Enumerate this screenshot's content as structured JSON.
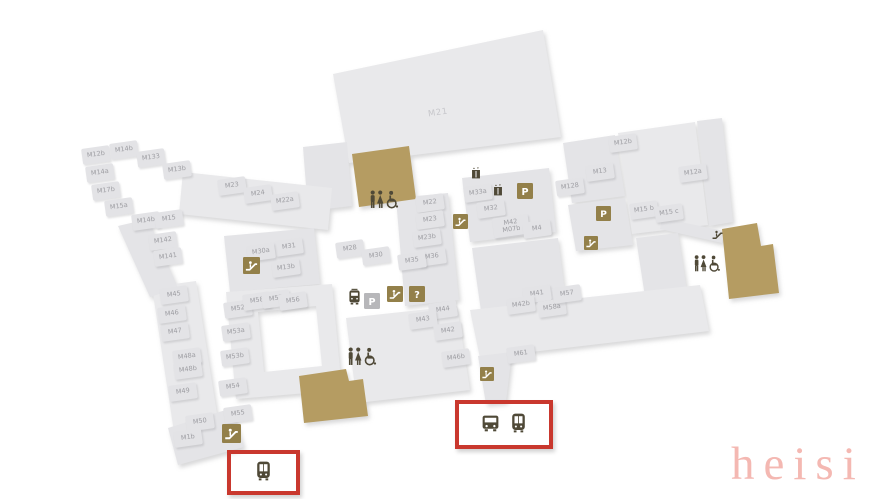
{
  "watermark": {
    "text": "heisi",
    "color": "#f4b8b2"
  },
  "map": {
    "colors": {
      "shape": "#e9e9eb",
      "unit_cell": "#e3e3e6",
      "unit_text": "#9c9ca1",
      "accent_building": "#b59c62",
      "icon_box": "#93804a",
      "glyph_dark": "#4f4937",
      "parking_gray_box": "#b7b7ba",
      "highlight_red": "#c9382e",
      "faint_label": "#c7c7cb"
    },
    "big_labels": [
      {
        "label": "M21",
        "x": 438,
        "y": 113
      }
    ],
    "units": [
      {
        "label": "M12b",
        "x": 96,
        "y": 155
      },
      {
        "label": "M14b",
        "x": 124,
        "y": 150
      },
      {
        "label": "M133",
        "x": 151,
        "y": 158
      },
      {
        "label": "M13b",
        "x": 177,
        "y": 170
      },
      {
        "label": "M14a",
        "x": 100,
        "y": 173
      },
      {
        "label": "M17b",
        "x": 106,
        "y": 191
      },
      {
        "label": "M15a",
        "x": 119,
        "y": 207
      },
      {
        "label": "M14b",
        "x": 146,
        "y": 221
      },
      {
        "label": "M15",
        "x": 169,
        "y": 219
      },
      {
        "label": "M142",
        "x": 163,
        "y": 241
      },
      {
        "label": "M141",
        "x": 168,
        "y": 257
      },
      {
        "label": "M23",
        "x": 232,
        "y": 186
      },
      {
        "label": "M24",
        "x": 258,
        "y": 194
      },
      {
        "label": "M22a",
        "x": 285,
        "y": 201
      },
      {
        "label": "M31",
        "x": 289,
        "y": 247
      },
      {
        "label": "M30a",
        "x": 261,
        "y": 252
      },
      {
        "label": "M13b",
        "x": 286,
        "y": 268
      },
      {
        "label": "M28",
        "x": 350,
        "y": 249
      },
      {
        "label": "M30",
        "x": 376,
        "y": 256
      },
      {
        "label": "M22",
        "x": 430,
        "y": 203
      },
      {
        "label": "M23",
        "x": 430,
        "y": 220
      },
      {
        "label": "M23b",
        "x": 427,
        "y": 238
      },
      {
        "label": "M36",
        "x": 432,
        "y": 257
      },
      {
        "label": "M35",
        "x": 412,
        "y": 261
      },
      {
        "label": "M33a",
        "x": 478,
        "y": 193
      },
      {
        "label": "M32",
        "x": 491,
        "y": 209
      },
      {
        "label": "M42\nM07b",
        "x": 511,
        "y": 226,
        "w": 30,
        "h": 18
      },
      {
        "label": "M4",
        "x": 537,
        "y": 229
      },
      {
        "label": "M128",
        "x": 570,
        "y": 187
      },
      {
        "label": "M13",
        "x": 600,
        "y": 172
      },
      {
        "label": "M12b",
        "x": 623,
        "y": 143
      },
      {
        "label": "M12a",
        "x": 693,
        "y": 173
      },
      {
        "label": "M15 b",
        "x": 644,
        "y": 210
      },
      {
        "label": "M15 c",
        "x": 669,
        "y": 213
      },
      {
        "label": "M45",
        "x": 174,
        "y": 295
      },
      {
        "label": "M46",
        "x": 172,
        "y": 314
      },
      {
        "label": "M47",
        "x": 175,
        "y": 332
      },
      {
        "label": "M48a",
        "x": 187,
        "y": 357
      },
      {
        "label": "M48b",
        "x": 188,
        "y": 370
      },
      {
        "label": "M49",
        "x": 183,
        "y": 392
      },
      {
        "label": "M50",
        "x": 200,
        "y": 422
      },
      {
        "label": "M1b",
        "x": 188,
        "y": 438
      },
      {
        "label": "M52",
        "x": 238,
        "y": 309
      },
      {
        "label": "M53a",
        "x": 236,
        "y": 332
      },
      {
        "label": "M53b",
        "x": 235,
        "y": 357
      },
      {
        "label": "M54",
        "x": 233,
        "y": 387
      },
      {
        "label": "M55",
        "x": 238,
        "y": 414
      },
      {
        "label": "M58",
        "x": 257,
        "y": 301
      },
      {
        "label": "M57",
        "x": 276,
        "y": 299
      },
      {
        "label": "M56",
        "x": 293,
        "y": 301
      },
      {
        "label": "M44",
        "x": 443,
        "y": 310
      },
      {
        "label": "M43",
        "x": 423,
        "y": 320
      },
      {
        "label": "M42",
        "x": 448,
        "y": 331
      },
      {
        "label": "M41",
        "x": 537,
        "y": 294
      },
      {
        "label": "M42b",
        "x": 521,
        "y": 305
      },
      {
        "label": "M46b",
        "x": 456,
        "y": 358
      },
      {
        "label": "M61",
        "x": 521,
        "y": 354
      },
      {
        "label": "M58a",
        "x": 552,
        "y": 308
      },
      {
        "label": "M57",
        "x": 567,
        "y": 294
      }
    ],
    "icons": [
      {
        "type": "restroom",
        "x": 368,
        "y": 189,
        "w": 32
      },
      {
        "type": "restroom",
        "x": 346,
        "y": 346,
        "w": 32
      },
      {
        "type": "restroom",
        "x": 692,
        "y": 254,
        "w": 30
      },
      {
        "type": "elevator",
        "x": 470,
        "y": 167,
        "w": 12
      },
      {
        "type": "elevator",
        "x": 492,
        "y": 184,
        "w": 12
      },
      {
        "type": "parking",
        "x": 517,
        "y": 183,
        "w": 16
      },
      {
        "type": "parking",
        "x": 596,
        "y": 206,
        "w": 15
      },
      {
        "type": "escalator",
        "x": 453,
        "y": 214,
        "w": 15
      },
      {
        "type": "escalator",
        "x": 584,
        "y": 236,
        "w": 14
      },
      {
        "type": "escalator",
        "x": 243,
        "y": 257,
        "w": 17
      },
      {
        "type": "escalator",
        "x": 222,
        "y": 424,
        "w": 19
      },
      {
        "type": "escalator",
        "x": 480,
        "y": 367,
        "w": 14
      },
      {
        "type": "tram",
        "x": 346,
        "y": 288,
        "w": 17
      },
      {
        "type": "parking-gray",
        "x": 364,
        "y": 293,
        "w": 16
      },
      {
        "type": "escalator",
        "x": 387,
        "y": 286,
        "w": 16
      },
      {
        "type": "info",
        "x": 409,
        "y": 286,
        "w": 16
      },
      {
        "type": "escalator-dark",
        "x": 710,
        "y": 227,
        "w": 15
      }
    ],
    "highlights": [
      {
        "x": 455,
        "y": 400,
        "w": 90,
        "h": 41,
        "icons": [
          "bus",
          "train"
        ],
        "icon_w": 21
      },
      {
        "x": 227,
        "y": 450,
        "w": 65,
        "h": 37,
        "icons": [
          "train"
        ],
        "icon_w": 21
      }
    ]
  }
}
